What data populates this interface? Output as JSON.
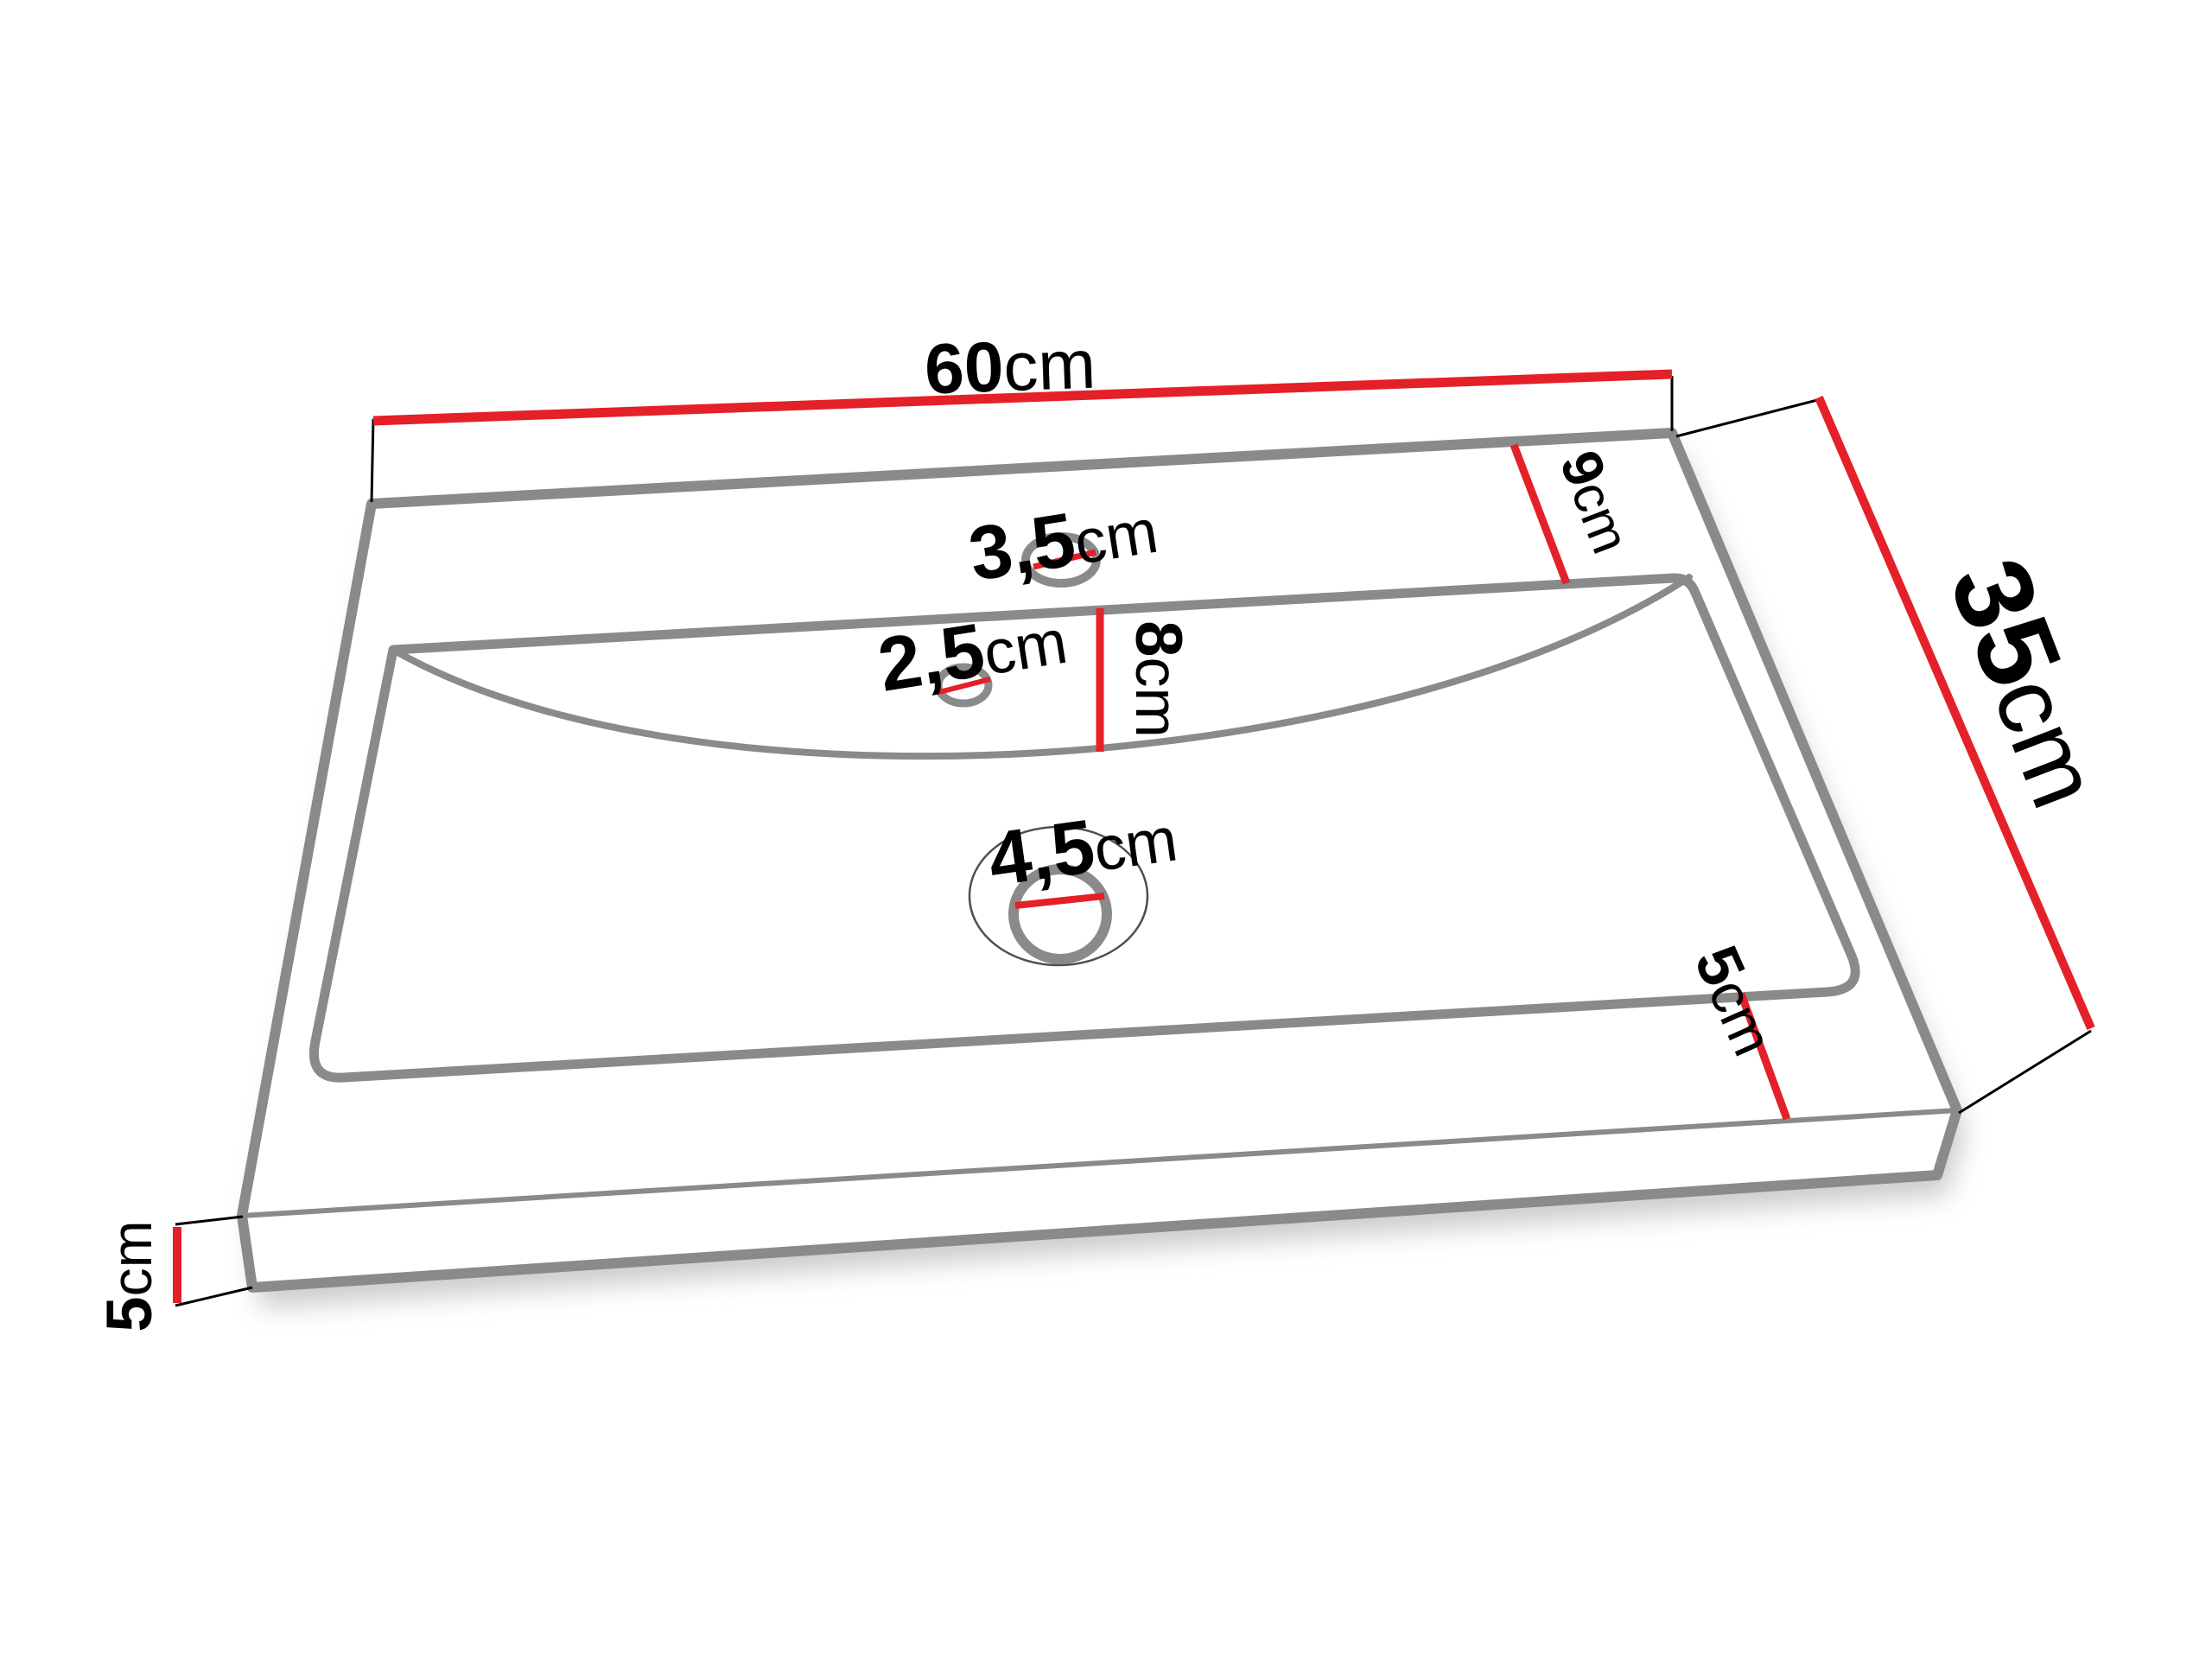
{
  "page": {
    "background": "#ffffff",
    "description": "Technical dimension drawing of a rectangular bathroom washbasin shown in perspective"
  },
  "diagram": {
    "type": "washbasin-dimension-drawing",
    "unit_system": "metric",
    "colors": {
      "dimension_line": "#e42028",
      "extension_line": "#000000",
      "body_outline": "#8a8a8a",
      "drain_outer_ring": "#4f4f4f",
      "label_text": "#000000",
      "background": "#ffffff"
    },
    "dimensions": {
      "overall_width": {
        "value": "60",
        "unit": "cm"
      },
      "overall_depth": {
        "value": "35",
        "unit": "cm"
      },
      "back_deck_depth": {
        "value": "9",
        "unit": "cm"
      },
      "basin_depth": {
        "value": "8",
        "unit": "cm"
      },
      "faucet_hole_diameter": {
        "value": "3,5",
        "unit": "cm"
      },
      "overflow_hole_diameter": {
        "value": "2,5",
        "unit": "cm"
      },
      "drain_hole_diameter": {
        "value": "4,5",
        "unit": "cm"
      },
      "front_rim_width": {
        "value": "5",
        "unit": "cm"
      },
      "side_edge_height": {
        "value": "5",
        "unit": "cm"
      }
    }
  }
}
